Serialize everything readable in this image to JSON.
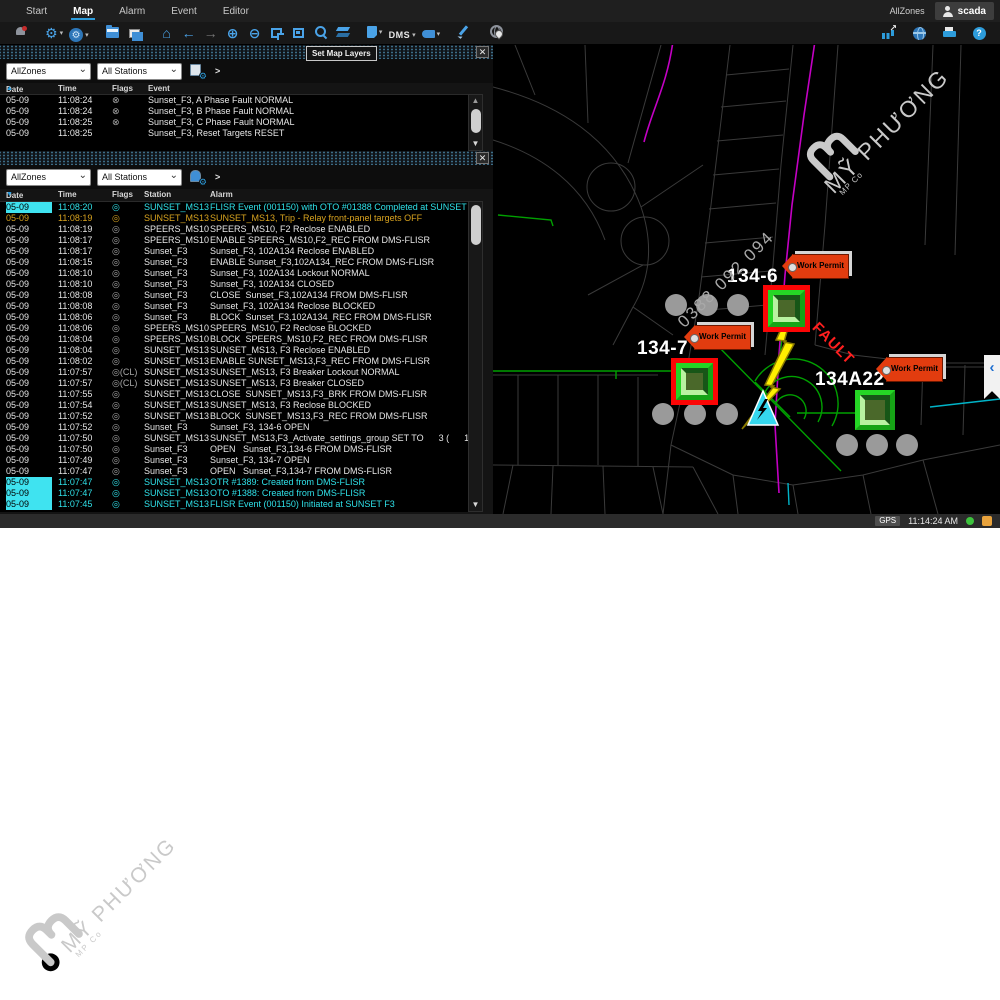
{
  "watermarks": {
    "brand": "MỸ PHƯƠNG",
    "brand_sub": "MP Co",
    "phone": "0388 092 094"
  },
  "menubar": {
    "tabs": [
      {
        "label": "Start"
      },
      {
        "label": "Map"
      },
      {
        "label": "Alarm"
      },
      {
        "label": "Event"
      },
      {
        "label": "Editor"
      }
    ],
    "active_tab": "Map",
    "zone_label": "AllZones",
    "user": "scada"
  },
  "toolbar": {
    "tooltip": "Set Map Layers",
    "dms_label": "DMS",
    "icons": [
      {
        "n": "alarm-bell-icon",
        "k": "bell"
      },
      {
        "k": "sep"
      },
      {
        "n": "settings-gear-icon",
        "g": "⚙",
        "dd": 1
      },
      {
        "n": "map-settings-icon",
        "k": "mapgear",
        "g": "⚙",
        "dd": 1
      },
      {
        "k": "sep"
      },
      {
        "n": "open-map-icon",
        "k": "folder"
      },
      {
        "n": "copy-window-icon",
        "k": "folder2"
      },
      {
        "k": "sep"
      },
      {
        "n": "home-icon",
        "g": "⌂"
      },
      {
        "n": "back-icon",
        "g": "←"
      },
      {
        "n": "forward-icon",
        "g": "→",
        "dis": 1
      },
      {
        "n": "zoom-in-icon",
        "g": "⊕"
      },
      {
        "n": "zoom-out-icon",
        "g": "⊖"
      },
      {
        "n": "zoom-window-icon",
        "k": "crop"
      },
      {
        "n": "zoom-fit-icon",
        "k": "fit"
      },
      {
        "n": "search-icon",
        "k": "mag"
      },
      {
        "n": "map-layers-icon",
        "k": "layers"
      },
      {
        "k": "sep"
      },
      {
        "n": "annotation-tag-icon",
        "k": "tag",
        "dd": 1
      },
      {
        "n": "dms-menu",
        "txt": "DMS",
        "dd": 1
      },
      {
        "n": "label-tag-icon",
        "k": "tag2",
        "dd": 1
      },
      {
        "k": "sep"
      },
      {
        "n": "sketch-pencil-icon",
        "k": "pencil"
      },
      {
        "k": "sep"
      },
      {
        "n": "locate-globe-icon",
        "k": "globepin"
      }
    ],
    "right_icons": [
      {
        "n": "trend-chart-icon",
        "k": "bars"
      },
      {
        "n": "web-globe-icon",
        "k": "globe"
      },
      {
        "n": "print-icon",
        "k": "printer"
      },
      {
        "n": "help-icon",
        "k": "help",
        "g": "?"
      }
    ]
  },
  "event_panel": {
    "zone_filter": "AllZones",
    "station_filter": "All Stations",
    "expand_label": ">",
    "close_label": "✕",
    "columns": {
      "date": "Date",
      "time": "Time",
      "flags": "Flags",
      "event": "Event"
    },
    "sort_dir": "▲",
    "rows": [
      {
        "d": "05-09",
        "t": "11:08:24",
        "f": "⊗",
        "e": "Sunset_F3, A Phase Fault NORMAL"
      },
      {
        "d": "05-09",
        "t": "11:08:24",
        "f": "⊗",
        "e": "Sunset_F3, B Phase Fault NORMAL"
      },
      {
        "d": "05-09",
        "t": "11:08:25",
        "f": "⊗",
        "e": "Sunset_F3, C Phase Fault NORMAL"
      },
      {
        "d": "05-09",
        "t": "11:08:25",
        "f": "",
        "e": "Sunset_F3, Reset Targets RESET"
      }
    ]
  },
  "alarm_panel": {
    "zone_filter": "AllZones",
    "station_filter": "All Stations",
    "expand_label": ">",
    "close_label": "✕",
    "columns": {
      "date": "Date",
      "time": "Time",
      "flags": "Flags",
      "station": "Station",
      "alarm": "Alarm"
    },
    "sort_dir": "▼",
    "rows": [
      {
        "d": "05-09",
        "t": "11:08:20",
        "f": "◎",
        "s": "SUNSET_MS13",
        "a": "FLISR Event (001150) with OTO #01388 Completed at SUNSET F3 .",
        "c": "cyan",
        "hl": 1
      },
      {
        "d": "05-09",
        "t": "11:08:19",
        "f": "◎",
        "s": "SUNSET_MS13",
        "a": "SUNSET_MS13, Trip - Relay front-panel targets OFF",
        "c": "amber"
      },
      {
        "d": "05-09",
        "t": "11:08:19",
        "f": "◎",
        "s": "SPEERS_MS10",
        "a": "SPEERS_MS10, F2 Reclose ENABLED"
      },
      {
        "d": "05-09",
        "t": "11:08:17",
        "f": "◎",
        "s": "SPEERS_MS10",
        "a": "ENABLE SPEERS_MS10,F2_REC FROM DMS-FLISR"
      },
      {
        "d": "05-09",
        "t": "11:08:17",
        "f": "◎",
        "s": "Sunset_F3",
        "a": "Sunset_F3, 102A134 Reclose ENABLED"
      },
      {
        "d": "05-09",
        "t": "11:08:15",
        "f": "◎",
        "s": "Sunset_F3",
        "a": "ENABLE Sunset_F3,102A134_REC FROM DMS-FLISR"
      },
      {
        "d": "05-09",
        "t": "11:08:10",
        "f": "◎",
        "s": "Sunset_F3",
        "a": "Sunset_F3, 102A134 Lockout NORMAL"
      },
      {
        "d": "05-09",
        "t": "11:08:10",
        "f": "◎",
        "s": "Sunset_F3",
        "a": "Sunset_F3, 102A134 CLOSED"
      },
      {
        "d": "05-09",
        "t": "11:08:08",
        "f": "◎",
        "s": "Sunset_F3",
        "a": "CLOSE  Sunset_F3,102A134 FROM DMS-FLISR"
      },
      {
        "d": "05-09",
        "t": "11:08:08",
        "f": "◎",
        "s": "Sunset_F3",
        "a": "Sunset_F3, 102A134 Reclose BLOCKED"
      },
      {
        "d": "05-09",
        "t": "11:08:06",
        "f": "◎",
        "s": "Sunset_F3",
        "a": "BLOCK  Sunset_F3,102A134_REC FROM DMS-FLISR"
      },
      {
        "d": "05-09",
        "t": "11:08:06",
        "f": "◎",
        "s": "SPEERS_MS10",
        "a": "SPEERS_MS10, F2 Reclose BLOCKED"
      },
      {
        "d": "05-09",
        "t": "11:08:04",
        "f": "◎",
        "s": "SPEERS_MS10",
        "a": "BLOCK  SPEERS_MS10,F2_REC FROM DMS-FLISR"
      },
      {
        "d": "05-09",
        "t": "11:08:04",
        "f": "◎",
        "s": "SUNSET_MS13",
        "a": "SUNSET_MS13, F3 Reclose ENABLED"
      },
      {
        "d": "05-09",
        "t": "11:08:02",
        "f": "◎",
        "s": "SUNSET_MS13",
        "a": "ENABLE SUNSET_MS13,F3_REC FROM DMS-FLISR"
      },
      {
        "d": "05-09",
        "t": "11:07:57",
        "f": "◎(CL)",
        "s": "SUNSET_MS13",
        "a": "SUNSET_MS13, F3 Breaker Lockout NORMAL"
      },
      {
        "d": "05-09",
        "t": "11:07:57",
        "f": "◎(CL)",
        "s": "SUNSET_MS13",
        "a": "SUNSET_MS13, F3 Breaker CLOSED"
      },
      {
        "d": "05-09",
        "t": "11:07:55",
        "f": "◎",
        "s": "SUNSET_MS13",
        "a": "CLOSE  SUNSET_MS13,F3_BRK FROM DMS-FLISR"
      },
      {
        "d": "05-09",
        "t": "11:07:54",
        "f": "◎",
        "s": "SUNSET_MS13",
        "a": "SUNSET_MS13, F3 Reclose BLOCKED"
      },
      {
        "d": "05-09",
        "t": "11:07:52",
        "f": "◎",
        "s": "SUNSET_MS13",
        "a": "BLOCK  SUNSET_MS13,F3_REC FROM DMS-FLISR"
      },
      {
        "d": "05-09",
        "t": "11:07:52",
        "f": "◎",
        "s": "Sunset_F3",
        "a": "Sunset_F3, 134-6 OPEN"
      },
      {
        "d": "05-09",
        "t": "11:07:50",
        "f": "◎",
        "s": "SUNSET_MS13",
        "a": "SUNSET_MS13,F3_Activate_settings_group SET TO      3 (      1) FROM"
      },
      {
        "d": "05-09",
        "t": "11:07:50",
        "f": "◎",
        "s": "Sunset_F3",
        "a": "OPEN   Sunset_F3,134-6 FROM DMS-FLISR"
      },
      {
        "d": "05-09",
        "t": "11:07:49",
        "f": "◎",
        "s": "Sunset_F3",
        "a": "Sunset_F3, 134-7 OPEN"
      },
      {
        "d": "05-09",
        "t": "11:07:47",
        "f": "◎",
        "s": "Sunset_F3",
        "a": "OPEN   Sunset_F3,134-7 FROM DMS-FLISR"
      },
      {
        "d": "05-09",
        "t": "11:07:47",
        "f": "◎",
        "s": "SUNSET_MS13",
        "a": "OTR #1389: Created from DMS-FLISR",
        "c": "cyan",
        "hl": 1
      },
      {
        "d": "05-09",
        "t": "11:07:47",
        "f": "◎",
        "s": "SUNSET_MS13",
        "a": "OTO #1388: Created from DMS-FLISR",
        "c": "cyan",
        "hl": 1
      },
      {
        "d": "05-09",
        "t": "11:07:45",
        "f": "◎",
        "s": "SUNSET_MS13",
        "a": "FLISR Event (001150) Initiated at SUNSET F3",
        "c": "cyan",
        "hl": 1
      }
    ]
  },
  "map": {
    "devices": {
      "sw1": {
        "label": "134-6"
      },
      "sw2": {
        "label": "134-7"
      },
      "sw3": {
        "label": "134A22"
      }
    },
    "work_permit_label": "Work Permit",
    "fault_label": "FAULT",
    "expander_label": "‹",
    "colors": {
      "feeder_green": "#00a000",
      "deenergized_magenta": "#c400c4",
      "tie_cyan": "#00a8b8",
      "fault_red": "#ff1f1f",
      "permit_tag": "#e23c0f"
    }
  },
  "statusbar": {
    "gps_label": "GPS",
    "time": "11:14:24 AM"
  }
}
